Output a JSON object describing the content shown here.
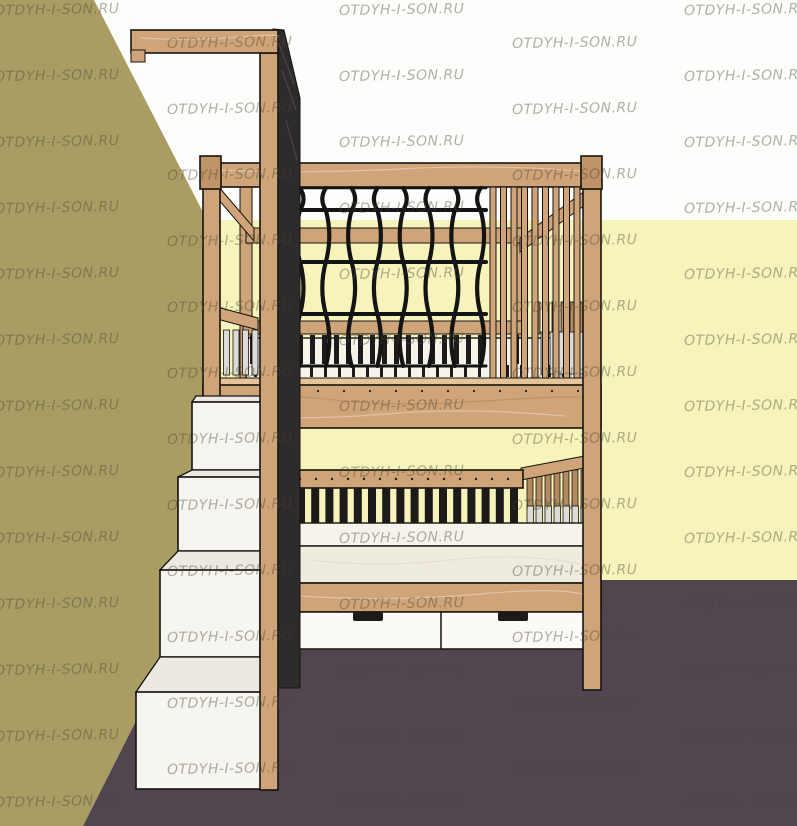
{
  "watermark": {
    "text": "OTDYH-I-SON.RU"
  },
  "colors": {
    "bg": "#fdfdfc",
    "wallLeft": "#aa9d64",
    "wallBack": "#f7f4bb",
    "floor": "#51464f",
    "wood": "#cfa478",
    "woodLight": "#e6c49a",
    "woodDark": "#b58a62",
    "woodCap": "#bf9468",
    "outline": "#16130f",
    "net": "#141414",
    "panel": "#2e2b2c",
    "mattressTop": "#f6f4ea",
    "mattressFront": "#efecdf",
    "stepFront": "#f6f5f0",
    "stepTread": "#ebe9e1",
    "drawer": "#fbfaf7",
    "slatShadow": "#dcdbd8",
    "slatDark": "#1d1b19",
    "watermark": "rgba(72,68,52,0.42)"
  }
}
